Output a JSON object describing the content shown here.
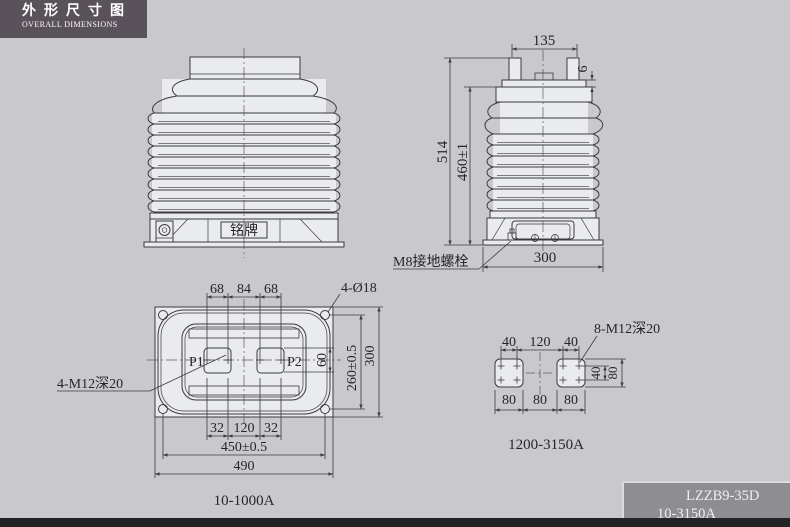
{
  "header": {
    "title_cn": "外形尺寸图",
    "title_en": "OVERALL DIMENSIONS"
  },
  "front_view": {
    "nameplate": "铭牌"
  },
  "side_view": {
    "dim_top_width": "135",
    "dim_flange_thickness": "6",
    "dim_total_height": "514",
    "dim_insulator_height": "460±1",
    "dim_base_depth": "300",
    "ground_bolt_label": "M8接地螺栓"
  },
  "plan_view": {
    "dim_top_left": "68",
    "dim_top_mid": "84",
    "dim_top_right": "68",
    "holes_label": "4-Ø18",
    "threads_label": "4-M12深20",
    "terminal_p1": "P1",
    "terminal_p2": "P2",
    "dim_terminal_height": "60",
    "dim_hole_span_v": "260±0.5",
    "dim_base_height": "300",
    "dim_bot_left": "32",
    "dim_bot_mid": "120",
    "dim_bot_right": "32",
    "dim_hole_span_h": "450±0.5",
    "dim_base_width": "490",
    "caption": "10-1000A"
  },
  "pad_view": {
    "dim_top_left": "40",
    "dim_top_mid": "120",
    "dim_top_right": "40",
    "threads_label": "8-M12深20",
    "dim_hole_v": "40",
    "dim_pad_v": "80",
    "dim_bot_left": "80",
    "dim_bot_mid": "80",
    "dim_bot_right": "80",
    "caption": "1200-3150A"
  },
  "title_block": {
    "model": "LZZB9-35D",
    "current_range": "10-3150A"
  },
  "colors": {
    "background": "#c9c9cd",
    "header_bg": "#5a525a",
    "title_block_bg": "#8e8e92",
    "drawing_fill": "#eaebed",
    "line": "#3b3b40"
  }
}
